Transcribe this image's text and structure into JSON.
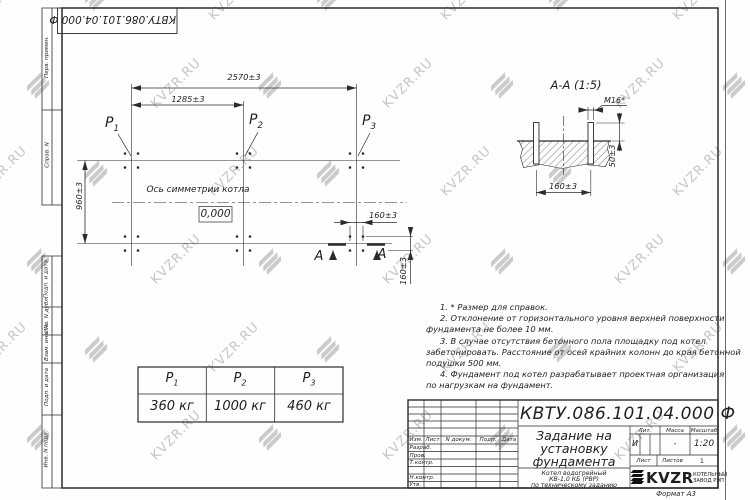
{
  "watermark": {
    "text": "KVZR.RU"
  },
  "top_stamp": {
    "text": "КВТУ.086.101.04.000  Ф"
  },
  "sidebar": {
    "items": [
      "Перв. примен.",
      "Справ. N",
      "Подп. и дата",
      "Инв. N дубл.",
      "Взам. инв. N",
      "Подп. и дата",
      "Инв. N подл."
    ]
  },
  "plan": {
    "dims": {
      "total": "2570±3",
      "half": "1285±3",
      "depth": "960±3",
      "h160": "160±3",
      "v160": "160±3"
    },
    "points": [
      {
        "base": "P",
        "sub": "1"
      },
      {
        "base": "P",
        "sub": "2"
      },
      {
        "base": "P",
        "sub": "3"
      }
    ],
    "axis_label": "Ось симметрии котла",
    "level_mark": "0,000",
    "section_letters": [
      "А",
      "А"
    ]
  },
  "section_view": {
    "title": "А-А (1:5)",
    "thread": "М16*",
    "dim_height": "50±3",
    "dim_spacing": "160±3"
  },
  "notes": [
    "1.  * Размер для справок.",
    "2.  Отклонение от горизонтального уровня верхней поверхности",
    "фундамента не более 10 мм.",
    "3.  В случае отсутствия бетонного пола площадку под котел",
    "забетонировать. Расстояние от осей крайних колонн до края бетонной",
    "подушки 500 мм.",
    "4.  Фундамент под котел разрабатывает проектная организация",
    "по нагрузкам на фундамент."
  ],
  "load_table": {
    "headers": [
      {
        "base": "P",
        "sub": "1"
      },
      {
        "base": "P",
        "sub": "2"
      },
      {
        "base": "P",
        "sub": "3"
      }
    ],
    "values": [
      "360 кг",
      "1000 кг",
      "460 кг"
    ]
  },
  "title_block": {
    "designation": "КВТУ.086.101.04.000  Ф",
    "title_lines": [
      "Задание на",
      "установку",
      "фундамента"
    ],
    "product_lines": [
      "Котел водогрейный",
      "КВ-1,0 КБ (РВР)",
      "по техническому заданию"
    ],
    "columns": {
      "izm": "Изм.",
      "list": "Лист",
      "ndok": "N докум.",
      "podp": "Подп.",
      "data": "Дата"
    },
    "rows": [
      "Разраб.",
      "Пров.",
      "Т.контр.",
      "",
      "Н.контр.",
      "Утв."
    ],
    "lit": {
      "label": "Лит.",
      "value": "И"
    },
    "mass": {
      "label": "Масса",
      "value": "-"
    },
    "scale": {
      "label": "Масштаб",
      "value": "1:20"
    },
    "sheet": {
      "label": "Лист"
    },
    "sheets": {
      "label": "Листов",
      "value": "1"
    },
    "logo": {
      "text": "KVZR",
      "factory_line1": "КОТЕЛЬНЫЙ",
      "factory_line2": "ЗАВОД РЭП"
    },
    "format": "Формат А3"
  },
  "colors": {
    "line": "#2b2b2b",
    "watermark": "#c6c6c6",
    "paper": "#fefefe"
  }
}
